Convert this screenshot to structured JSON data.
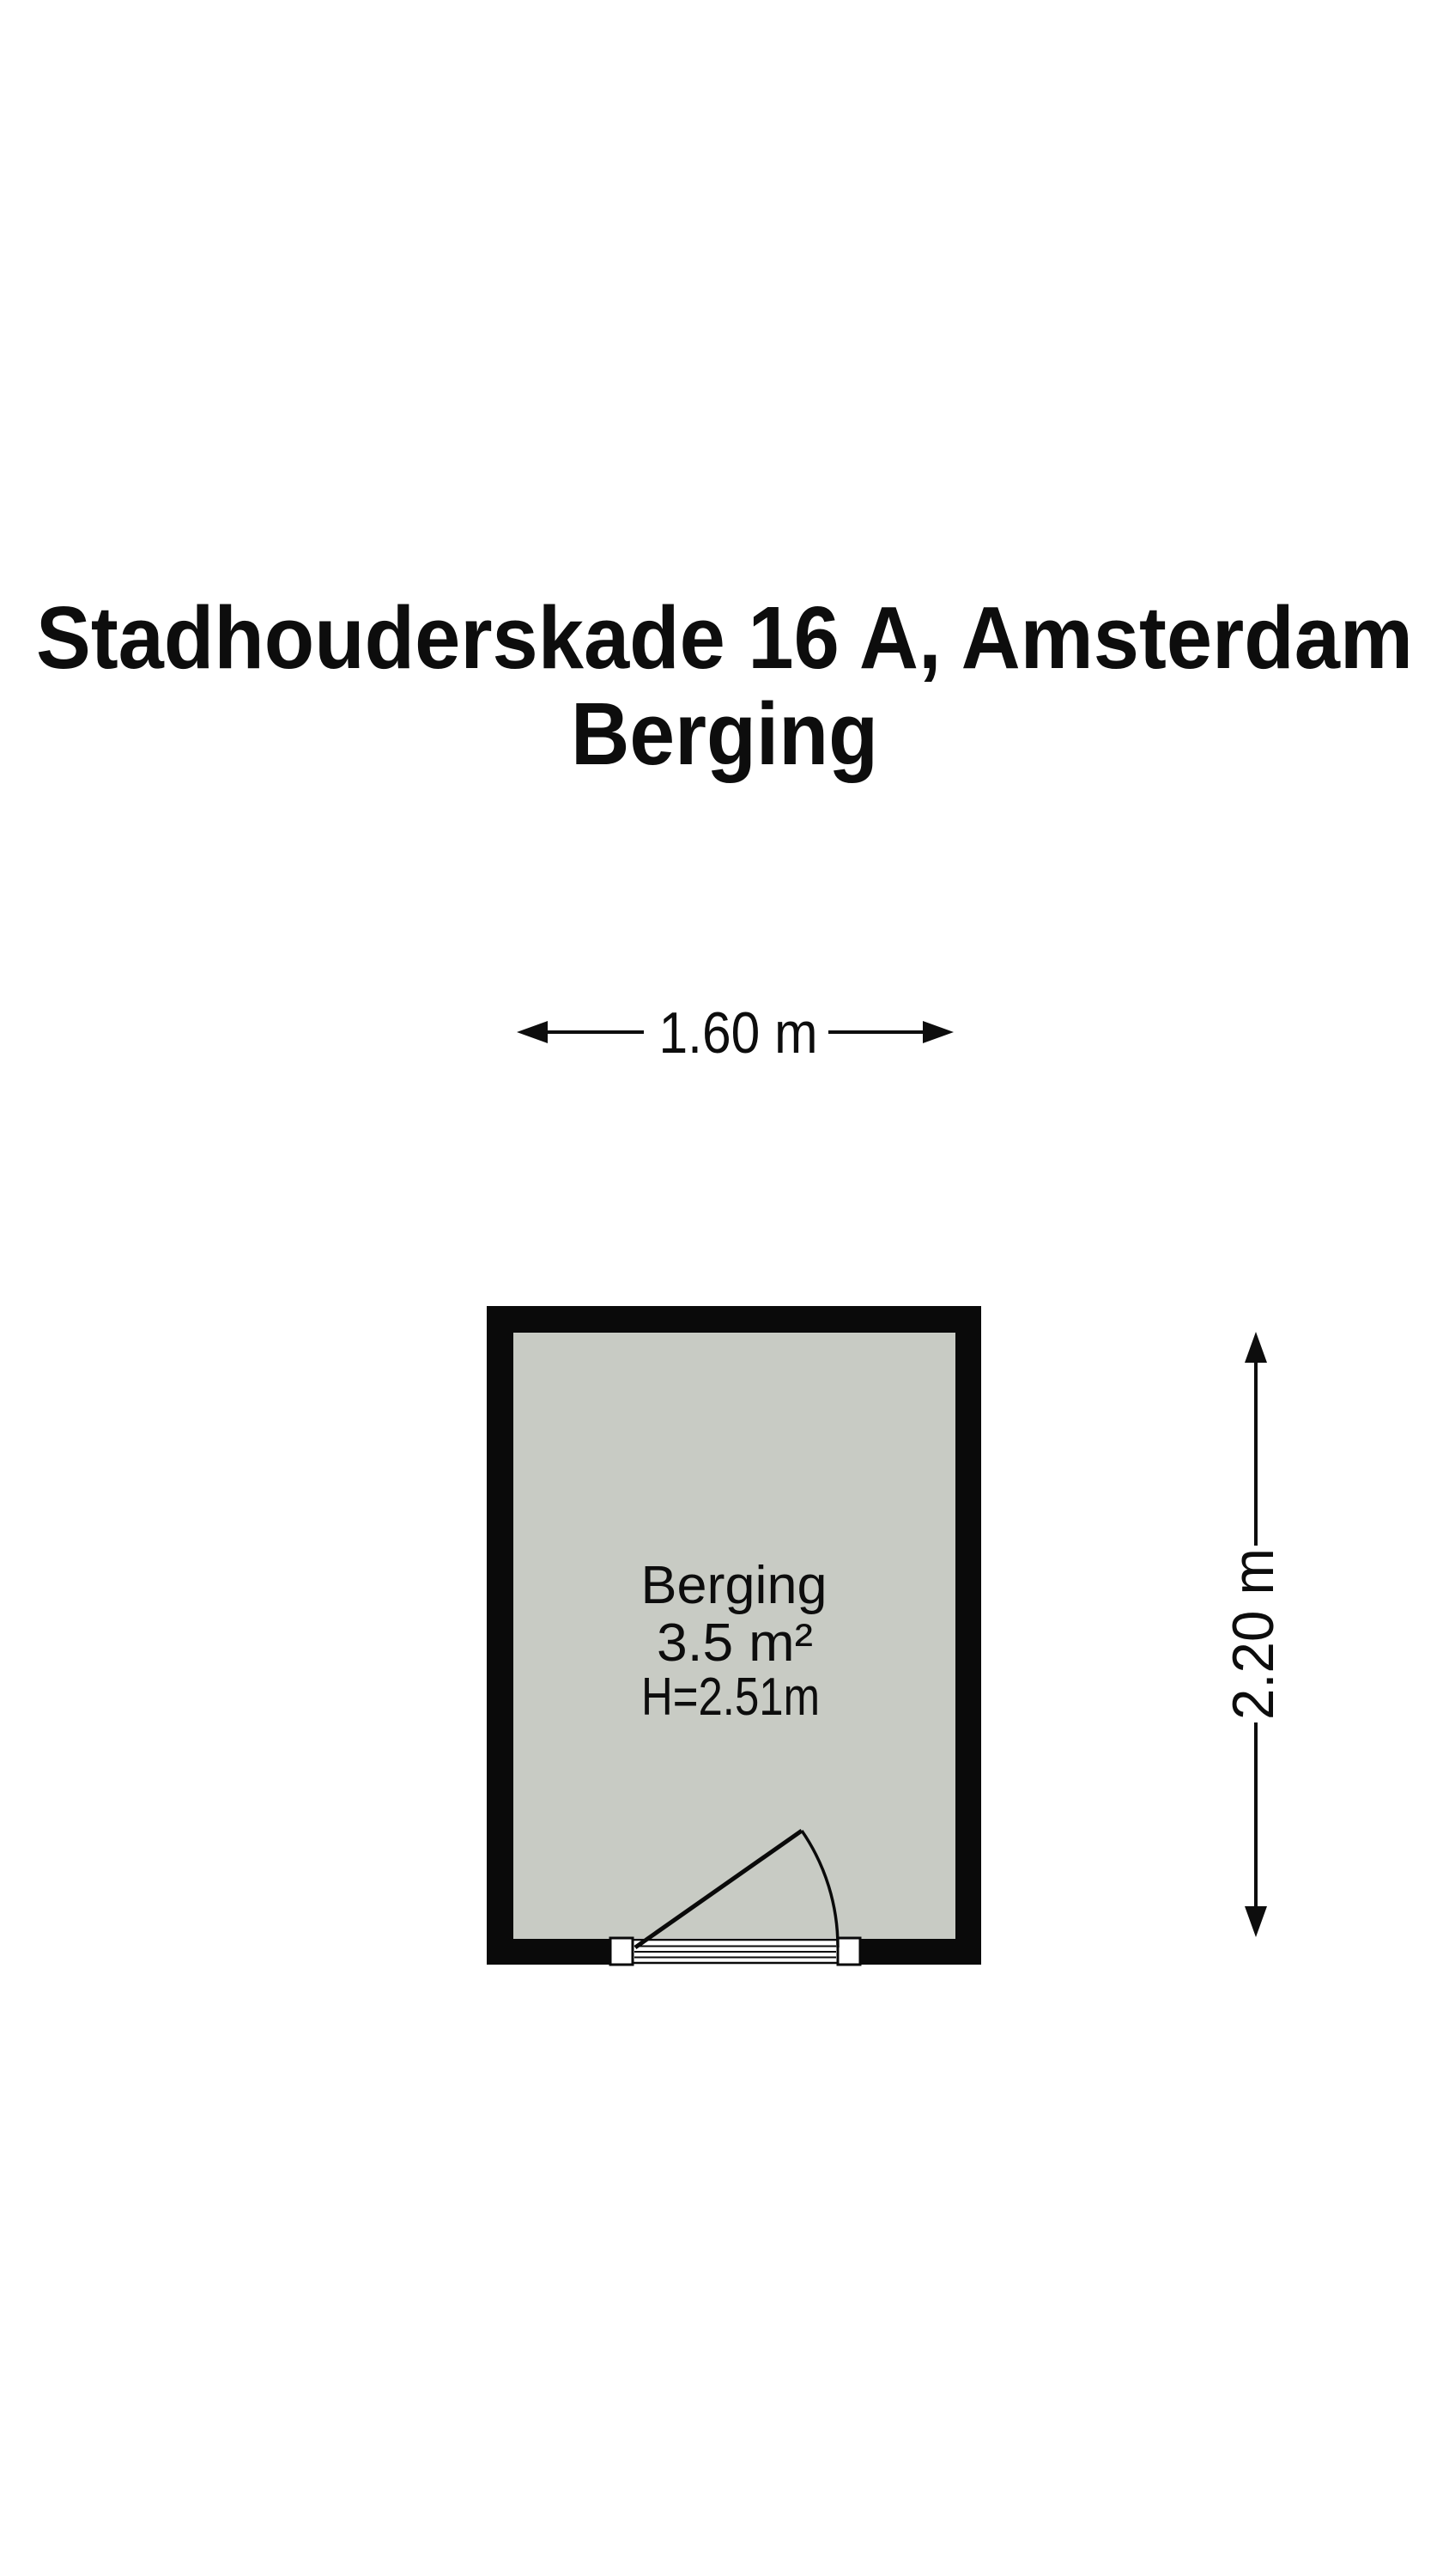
{
  "title": {
    "line1": "Stadhouderskade 16 A, Amsterdam",
    "line2": "Berging"
  },
  "floor_plan": {
    "room": {
      "name": "Berging",
      "area": "3.5 m²",
      "ceiling_height": "H=2.51m"
    },
    "dimensions": {
      "width_label": "1.60 m",
      "height_label": "2.20 m"
    },
    "colors": {
      "wall": "#0a0a0a",
      "floor": "#c8cbc4",
      "text": "#0d0d0d",
      "background": "#ffffff"
    }
  }
}
